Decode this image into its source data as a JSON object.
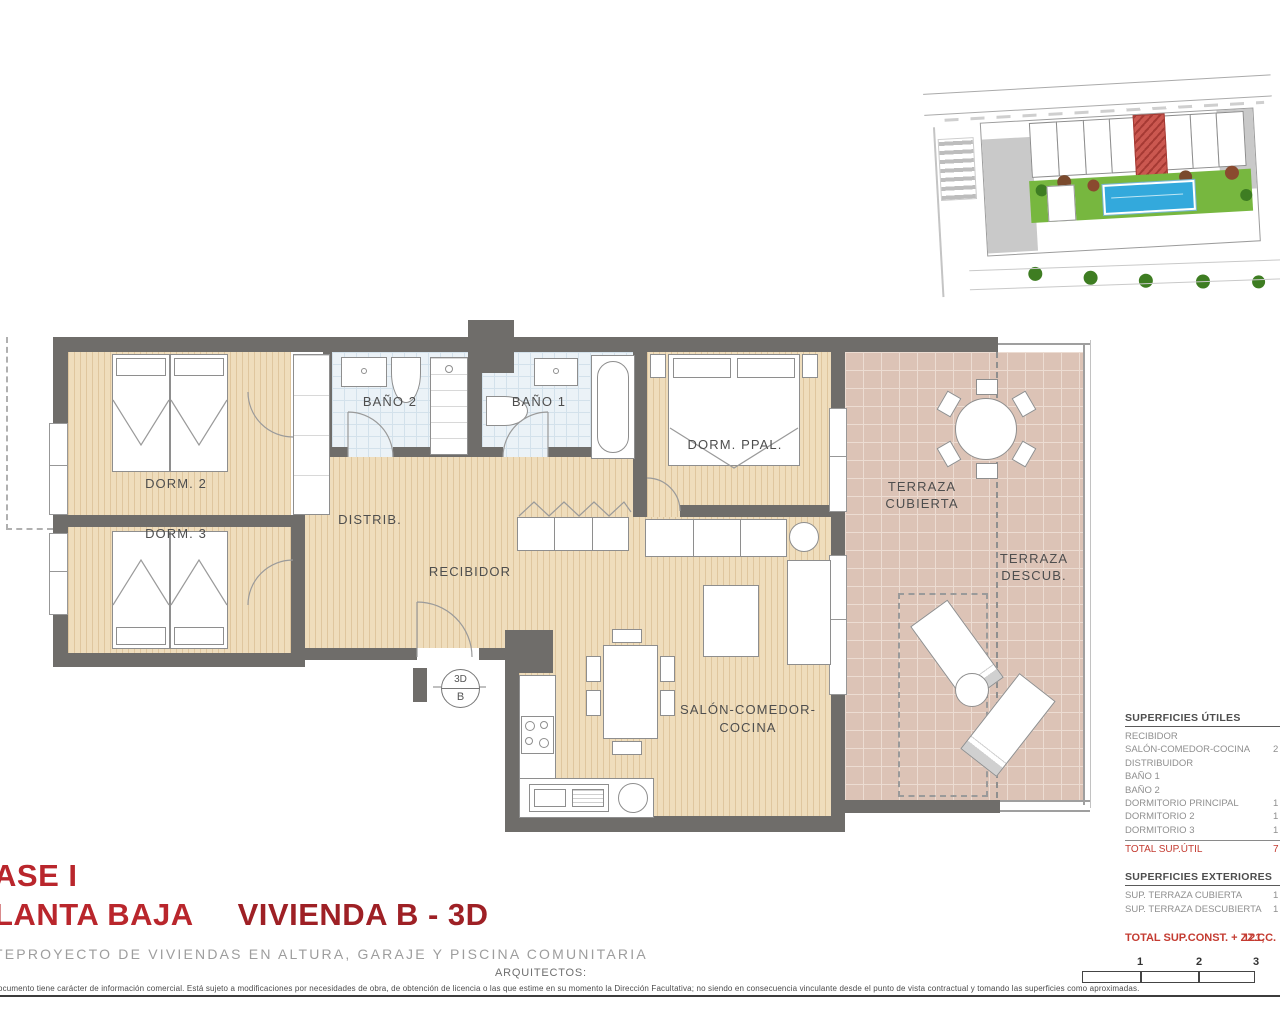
{
  "palette": {
    "wall": "#6f6d6a",
    "wood": "#efddbc",
    "wood-stripe": "#dfc69e",
    "bath": "#ebf2f7",
    "bath-grid": "#d3e1eb",
    "terrace": "#dcc3b6",
    "terrace-grid": "#ecdcd2",
    "title-red": "#b9262c",
    "title-red-dark": "#9e2025",
    "table-red": "#c43b31",
    "site-green": "#77b73f",
    "site-green-dark": "#3e7d22",
    "site-pool": "#33a9dc",
    "site-red": "#cb5850",
    "site-gray": "#c9c9c9"
  },
  "plan": {
    "rooms": {
      "dorm2": "DORM. 2",
      "dorm3": "DORM. 3",
      "bano2": "BAÑO 2",
      "bano1": "BAÑO 1",
      "dorm_ppal": "DORM. PPAL.",
      "distrib": "DISTRIB.",
      "recibidor": "RECIBIDOR",
      "salon_line1": "SALÓN-COMEDOR-",
      "salon_line2": "COCINA",
      "terraza_cub_line1": "TERRAZA",
      "terraza_cub_line2": "CUBIERTA",
      "terraza_desc_line1": "TERRAZA",
      "terraza_desc_line2": "DESCUB."
    },
    "marker": {
      "top": "3D",
      "bottom": "B"
    }
  },
  "titles": {
    "fase": "ASE I",
    "planta": "LANTA BAJA",
    "vivienda": "VIVIENDA B - 3D",
    "subtitle": "TEPROYECTO DE VIVIENDAS EN ALTURA, GARAJE Y PISCINA COMUNITARIA",
    "architects": "ARQUITECTOS:"
  },
  "tables": {
    "utiles": {
      "header": "SUPERFICIES ÚTILES",
      "rows": [
        {
          "label": "RECIBIDOR",
          "value": ""
        },
        {
          "label": "SALÓN-COMEDOR-COCINA",
          "value": "2"
        },
        {
          "label": "DISTRIBUIDOR",
          "value": ""
        },
        {
          "label": "BAÑO 1",
          "value": ""
        },
        {
          "label": "BAÑO 2",
          "value": ""
        },
        {
          "label": "DORMITORIO PRINCIPAL",
          "value": "1"
        },
        {
          "label": "DORMITORIO 2",
          "value": "1"
        },
        {
          "label": "DORMITORIO 3",
          "value": "1"
        }
      ],
      "total_label": "TOTAL SUP.ÚTIL",
      "total_value": "7"
    },
    "exteriores": {
      "header": "SUPERFICIES EXTERIORES",
      "rows": [
        {
          "label": "SUP. TERRAZA CUBIERTA",
          "value": "1"
        },
        {
          "label": "SUP. TERRAZA DESCUBIERTA",
          "value": "1"
        }
      ]
    },
    "total_const": {
      "label": "TOTAL SUP.CONST. + ZZ.CC.",
      "value": "121,"
    }
  },
  "scale_bar": {
    "labels": [
      "1",
      "2",
      "3"
    ]
  },
  "disclaimer": "ocumento tiene carácter de información comercial. Está sujeto a modificaciones por necesidades de obra, de obtención de licencia o las que estime en su momento la Dirección Facultativa; no siendo en consecuencia vinculante desde el punto de vista contractual y tomando las superficies como aproximadas."
}
